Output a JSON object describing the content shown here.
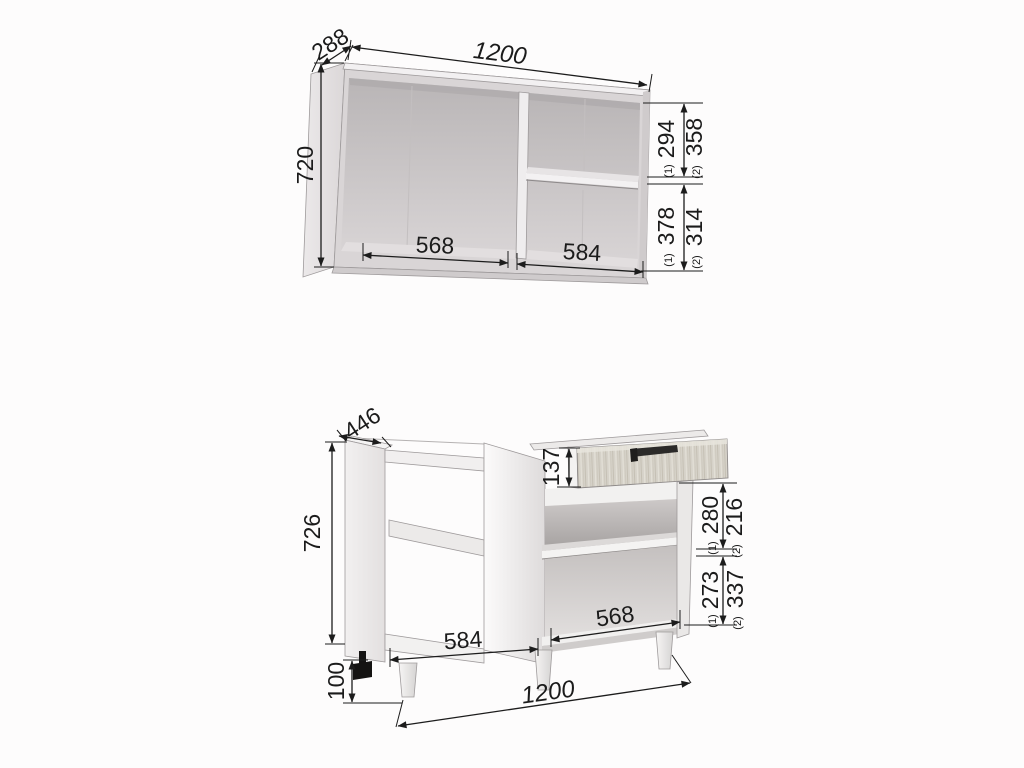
{
  "sup": {
    "one": "(1)",
    "two": "(2)"
  },
  "wall_cabinet": {
    "width": "1200",
    "depth": "288",
    "height": "720",
    "left_compartment_width": "568",
    "right_compartment_width": "584",
    "upper_height_v1": "294",
    "upper_height_v2": "358",
    "lower_height_v1": "378",
    "lower_height_v2": "314"
  },
  "base_cabinet": {
    "width": "1200",
    "depth": "446",
    "height": "726",
    "leg_height": "100",
    "drawer_front_height": "137",
    "left_compartment_width": "584",
    "right_compartment_width": "568",
    "upper_height_v1": "280",
    "upper_height_v2": "216",
    "lower_height_v1": "273",
    "lower_height_v2": "337"
  },
  "colors": {
    "dimension_line": "#1b1b1b",
    "text": "#1b1b1b",
    "carcass_gray": "#d9d5d6",
    "interior_gray": "#c3bfc0",
    "panel_white": "#f1efef",
    "wood_drawer": "#d6d2c9",
    "handle_dark": "#2b2a29",
    "background": "#fdfcfc"
  }
}
